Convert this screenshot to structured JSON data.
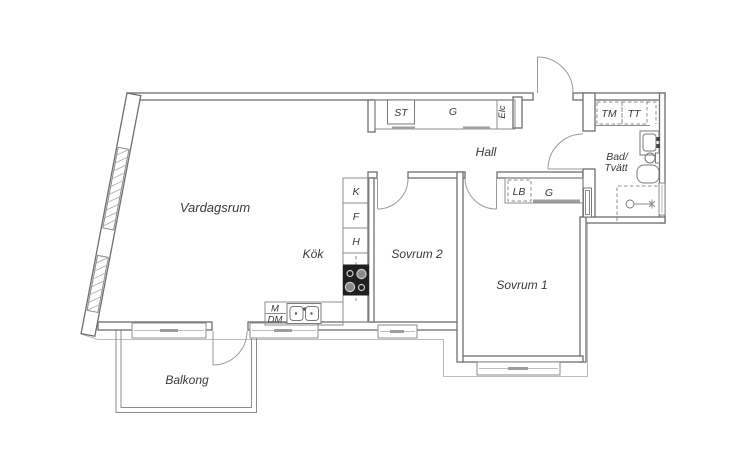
{
  "meta": {
    "type": "floor-plan",
    "language": "Swedish",
    "colors": {
      "background": "#ffffff",
      "wall_line": "#6e6e6e",
      "thin_line": "#8c8c8c",
      "label_text": "#3a3a3a",
      "stove": "#1f1f1f",
      "closet_front": "#9e9e9e"
    }
  },
  "labels": {
    "rooms": {
      "vardagsrum": "Vardagsrum",
      "kok": "Kök",
      "sovrum2": "Sovrum 2",
      "sovrum1": "Sovrum 1",
      "hall": "Hall",
      "bad_line1": "Bad/",
      "bad_line2": "Tvätt",
      "balkong": "Balkong"
    },
    "fixtures": {
      "st": "ST",
      "g_hall": "G",
      "elc": "Elc",
      "tm": "TM",
      "tt": "TT",
      "lb": "LB",
      "g_sovrum": "G",
      "k": "K",
      "f": "F",
      "h": "H",
      "m": "M",
      "dm": "DM"
    }
  }
}
